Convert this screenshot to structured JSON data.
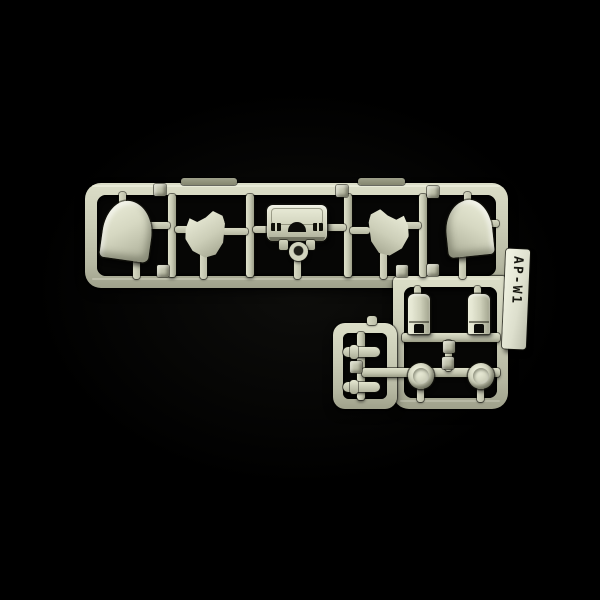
{
  "photo": {
    "subject": "injection-molded plastic model kit runner (sprue) photographed on a black background",
    "runner_label": "AP-W1",
    "plastic_color": "#cdd0ba",
    "background_color": "#000000",
    "layout": {
      "shape": "L-shaped runner: long horizontal band on top, smaller rectangular section hanging bottom-right",
      "label_position": "white tag on right edge, vertical text"
    },
    "parts_inventory": {
      "rounded_pod_parts": 2,
      "angled_flap_parts": 2,
      "core_box_part": 1,
      "ring_part": 1,
      "sleeve_cuff_parts": 2,
      "dome_cap_parts": 2,
      "cylinder_peg_parts": 2,
      "molded_number_tabs": 9
    }
  }
}
